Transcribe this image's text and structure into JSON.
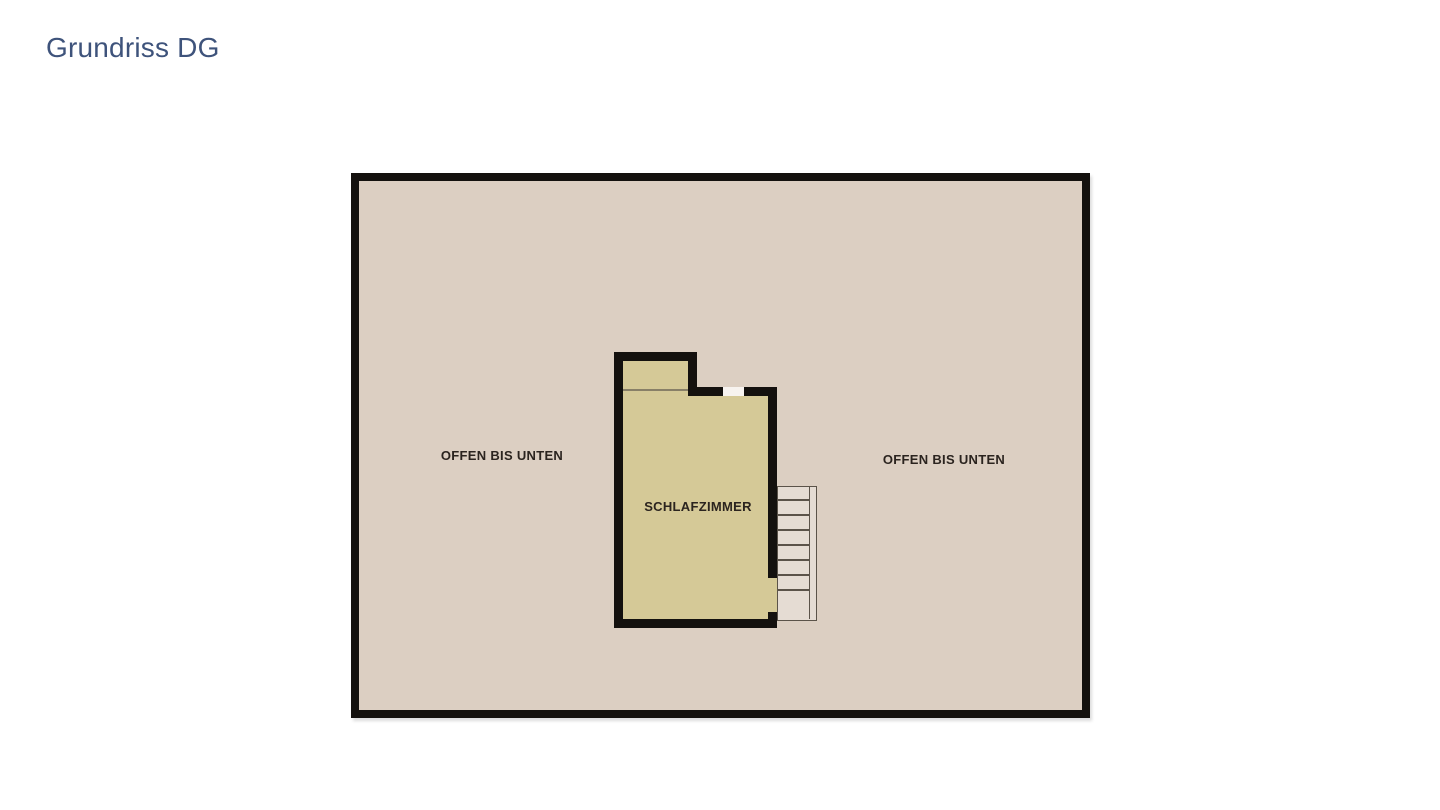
{
  "title": "Grundriss DG",
  "floor_plan": {
    "labels": {
      "open_left": "OFFEN BIS UNTEN",
      "open_right": "OFFEN BIS UNTEN",
      "room": "SCHLAFZIMMER"
    },
    "staircase": {
      "treads": 7
    }
  },
  "colors": {
    "title_color": "#3e537b",
    "wall_color": "#14110e",
    "floor_color": "#dccfc2",
    "room_fill": "#d5c997",
    "stair_line": "#5b5349",
    "label_color": "#2b241f",
    "opening_color": "#f7f3ef"
  }
}
